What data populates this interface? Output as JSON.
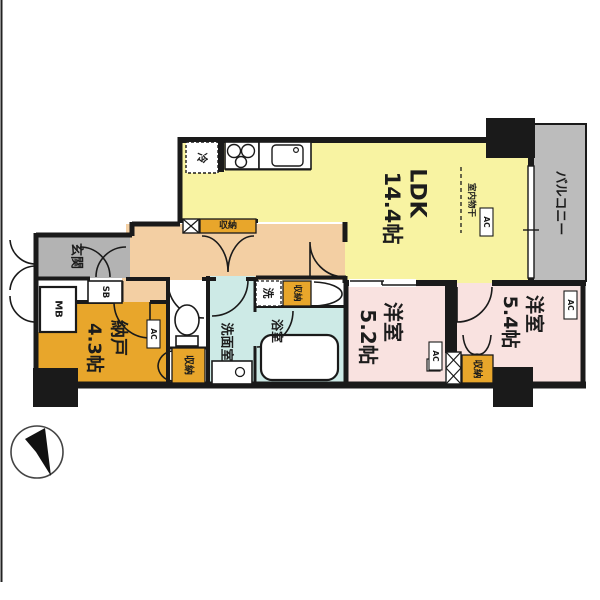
{
  "colors": {
    "wall": "#1a1a1a",
    "ldk": "#f8f3a2",
    "bedroom": "#f9e2e0",
    "storage": "#e8a62b",
    "corridor": "#f3cfa3",
    "entrance_gray": "#b3b3b3",
    "balcony_gray": "#bcbcbc",
    "wet_area": "#cdeae6",
    "white": "#ffffff"
  },
  "rooms": {
    "ldk": {
      "label": "LDK",
      "area": "14.4帖"
    },
    "bedroom_52": {
      "label": "洋室",
      "area": "5.2帖"
    },
    "bedroom_54": {
      "label": "洋室",
      "area": "5.4帖"
    },
    "storage_room": {
      "label": "納戸",
      "area": "4.3帖"
    },
    "balcony": {
      "label": "バルコニー"
    },
    "entrance": {
      "label": "玄関"
    },
    "washroom": {
      "label": "洗面室"
    },
    "bathroom": {
      "label": "浴室"
    }
  },
  "fixtures": {
    "closet": "収納",
    "refrigerator": "冷",
    "washer": "洗",
    "meter_box": "MB",
    "shoe_box": "SB",
    "air_conditioner": "AC",
    "indoor_drying_pole": "室内物干"
  }
}
